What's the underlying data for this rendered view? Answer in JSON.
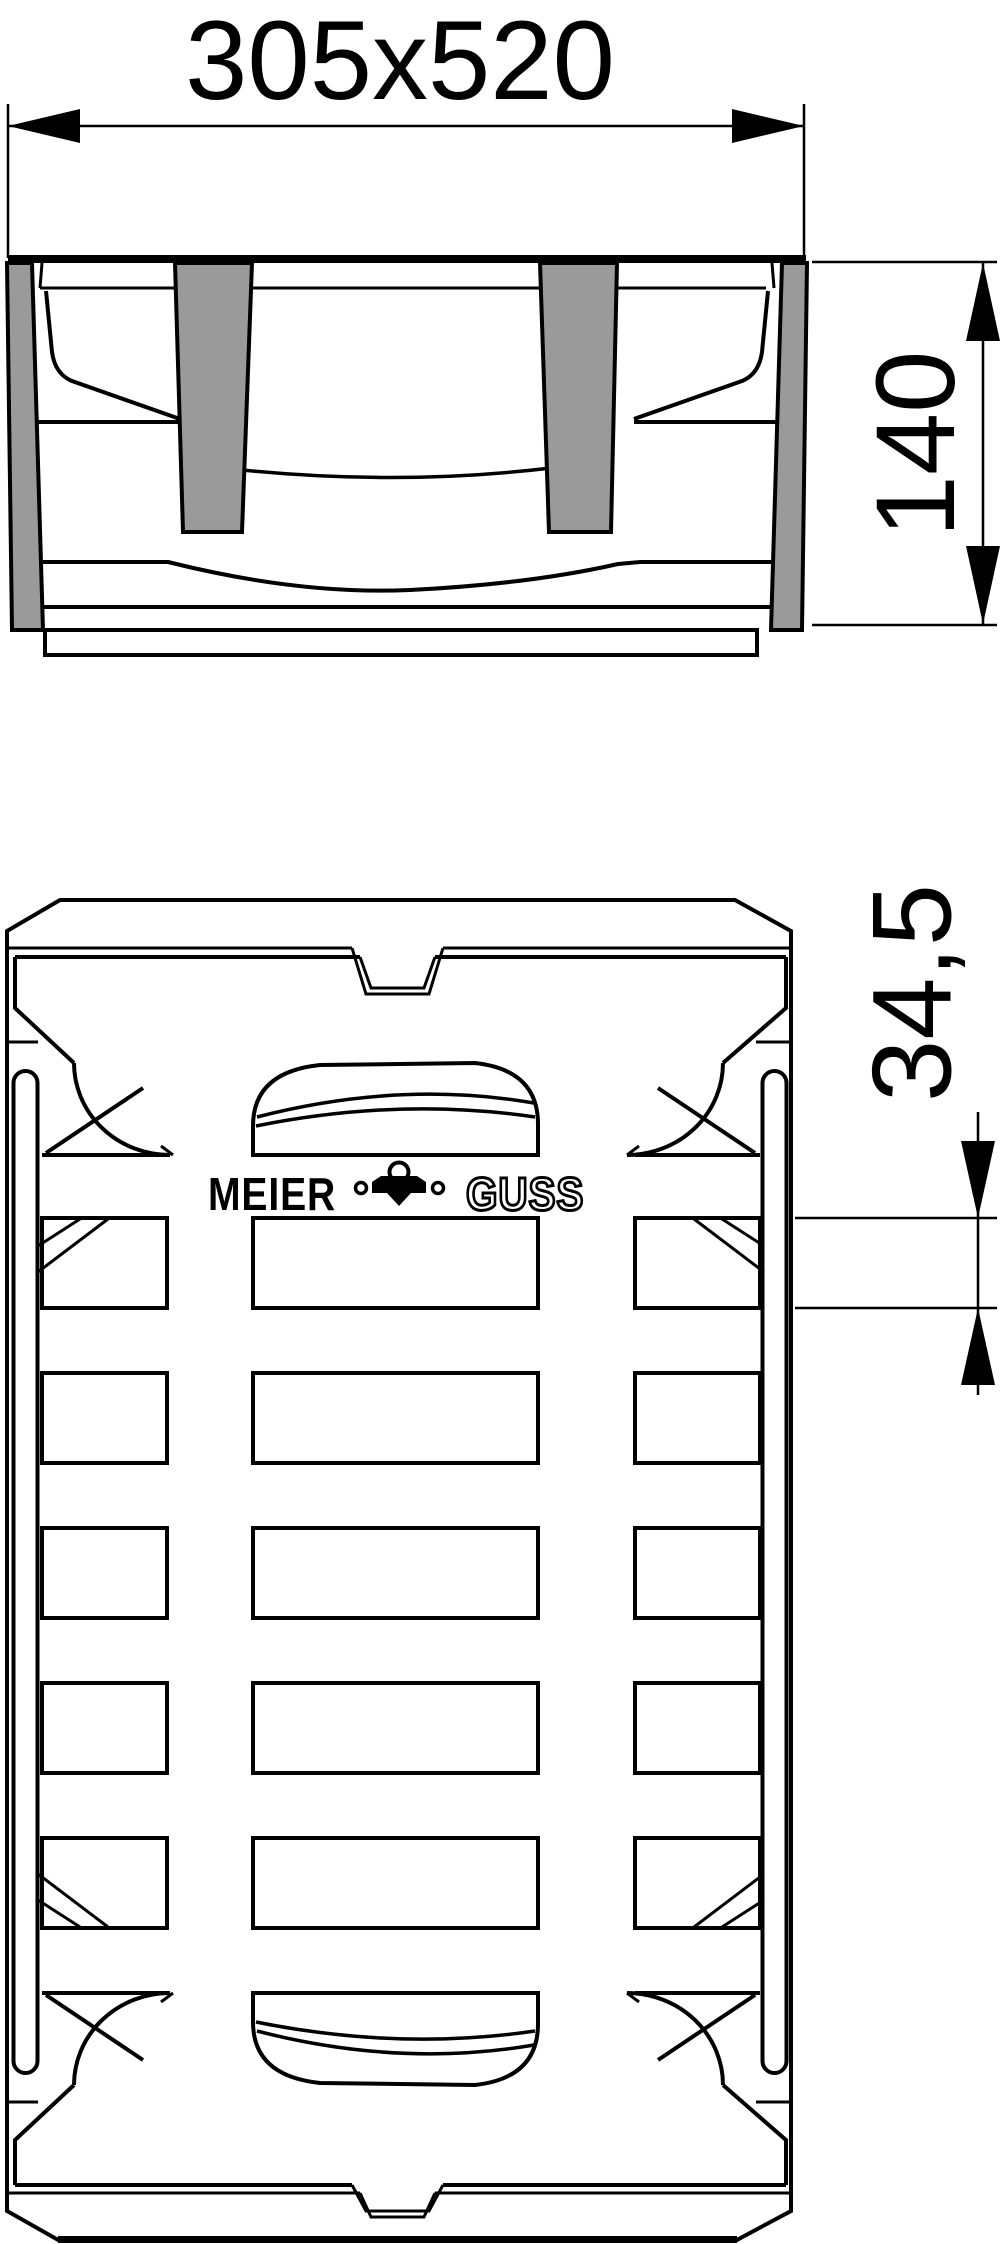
{
  "dimensions": {
    "width": "305x520",
    "height": "140",
    "slot_height": "34,5"
  },
  "branding": {
    "manufacturer": "MEIER",
    "material": "GUSS"
  },
  "colors": {
    "line": "#000000",
    "gray_fill": "#9a9a9a",
    "background": "#ffffff"
  }
}
